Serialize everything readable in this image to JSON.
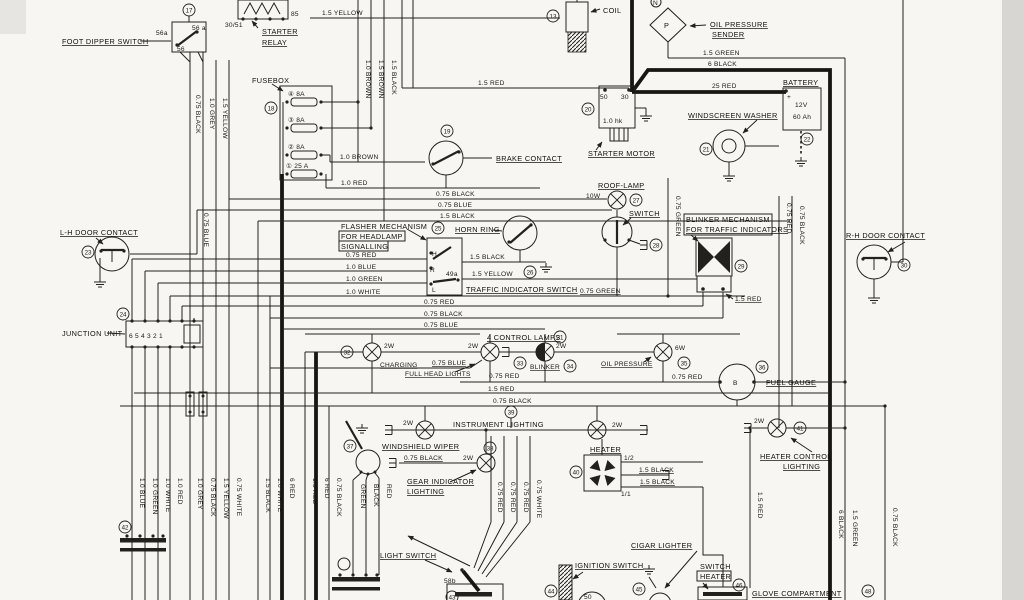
{
  "diagram_type": "vehicle wiring schematic",
  "wire": {
    "y15": "1.5 YELLOW",
    "r15": "1.5 RED",
    "r25": "25 RED",
    "g15": "1.5 GREEN",
    "bk6": "6 BLACK",
    "bk075": "0.75 BLACK",
    "bu075": "0.75 BLUE",
    "bk15": "1.5 BLACK",
    "bn10": "1.0 BROWN",
    "bn15": "1.5 BROWN",
    "rd10": "1.0 RED",
    "rd075": "0.75 RED",
    "bu10": "1.0 BLUE",
    "gn10": "1.0 GREEN",
    "wh10": "1.0 WHITE",
    "gy10": "1.0 GREY",
    "wh075": "0.75 WHITE",
    "rd6": "6 RED",
    "gn075": "0.75 GREEN",
    "green": "GREEN",
    "black": "BLACK",
    "red": "RED"
  },
  "comp": {
    "foot_dipper": "FOOT DIPPER SWITCH",
    "starter": "STARTER",
    "relay": "RELAY",
    "fusebox": "FUSEBOX",
    "coil": "COIL",
    "brake": "BRAKE CONTACT",
    "starter_motor": "STARTER MOTOR",
    "oil_sender1": "OIL PRESSURE",
    "oil_sender2": "SENDER",
    "battery": "BATTERY",
    "washer": "WINDSCREEN WASHER",
    "lh_door": "L-H DOOR CONTACT",
    "rh_door": "R-H DOOR CONTACT",
    "junction": "JUNCTION UNIT",
    "flasher1": "FLASHER MECHANISM",
    "flasher2": "FOR HEADLAMP",
    "flasher3": "SIGNALLING",
    "horn": "HORN RING",
    "roof": "ROOF-LAMP",
    "roof_switch": "SWITCH",
    "blink1": "BLINKER MECHANISM",
    "blink2": "FOR TRAFFIC INDICATORS",
    "tis": "TRAFFIC INDICATOR SWITCH",
    "ctrl": "4 CONTROL LAMPS",
    "charging": "CHARGING",
    "fhl": "FULL HEAD LIGHTS",
    "blinker": "BLINKER",
    "oilp": "OIL PRESSURE",
    "fuel": "FUEL GAUGE",
    "instr": "INSTRUMENT LIGHTING",
    "wiper": "WINDSHIELD WIPER",
    "gear1": "GEAR INDICATOR",
    "gear2": "LIGHTING",
    "heater": "HEATER",
    "hcl1": "HEATER CONTROL",
    "hcl2": "LIGHTING",
    "light_switch": "LIGHT SWITCH",
    "ign": "IGNITION SWITCH",
    "cigar": "CIGAR LIGHTER",
    "swh1": "SWITCH",
    "swh2": "HEATER",
    "glove1": "GLOVE COMPARTMENT",
    "glove2": "LIGHTING"
  },
  "fuse": {
    "f4": "④ 8A",
    "f3": "③ 8A",
    "f2": "② 8A",
    "f1": "① 25 A"
  },
  "term": {
    "t3051": "30/51",
    "t85": "85",
    "t56a": "56a",
    "t56a2": "56 a",
    "t56": "56",
    "t50": "50",
    "t30": "30",
    "hk": "1.0 hk",
    "h": "H",
    "r": "R",
    "l": "L",
    "t49a": "49a",
    "t58b": "58b",
    "t50i": "50",
    "half": "1/2",
    "oneone": "1/1",
    "b": "B",
    "p": "P",
    "n": "N",
    "plus": "+",
    "jnums": "6 5 4 3 2 1"
  },
  "watt": {
    "w2": "2W",
    "w6": "6W",
    "w10": "10W"
  },
  "batt": {
    "v": "12V",
    "ah": "60 Ah"
  },
  "num": {
    "n13": "13",
    "n17": "17",
    "n18": "18",
    "n19": "19",
    "n20": "20",
    "n21": "21",
    "n22": "22",
    "n23": "23",
    "n24": "24",
    "n25": "25",
    "n26": "26",
    "n27": "27",
    "n28": "28",
    "n29": "29",
    "n30": "30",
    "n31": "31",
    "n32": "32",
    "n33": "33",
    "n34": "34",
    "n35": "35",
    "n36": "36",
    "n37": "37",
    "n38": "38",
    "n39": "39",
    "n40": "40",
    "n41": "41",
    "n42": "42",
    "n43": "43",
    "n44": "44",
    "n45": "45",
    "n46": "46",
    "n48": "48"
  },
  "colors": {
    "ink": "#22211d",
    "paper": "#f7f6f2"
  }
}
